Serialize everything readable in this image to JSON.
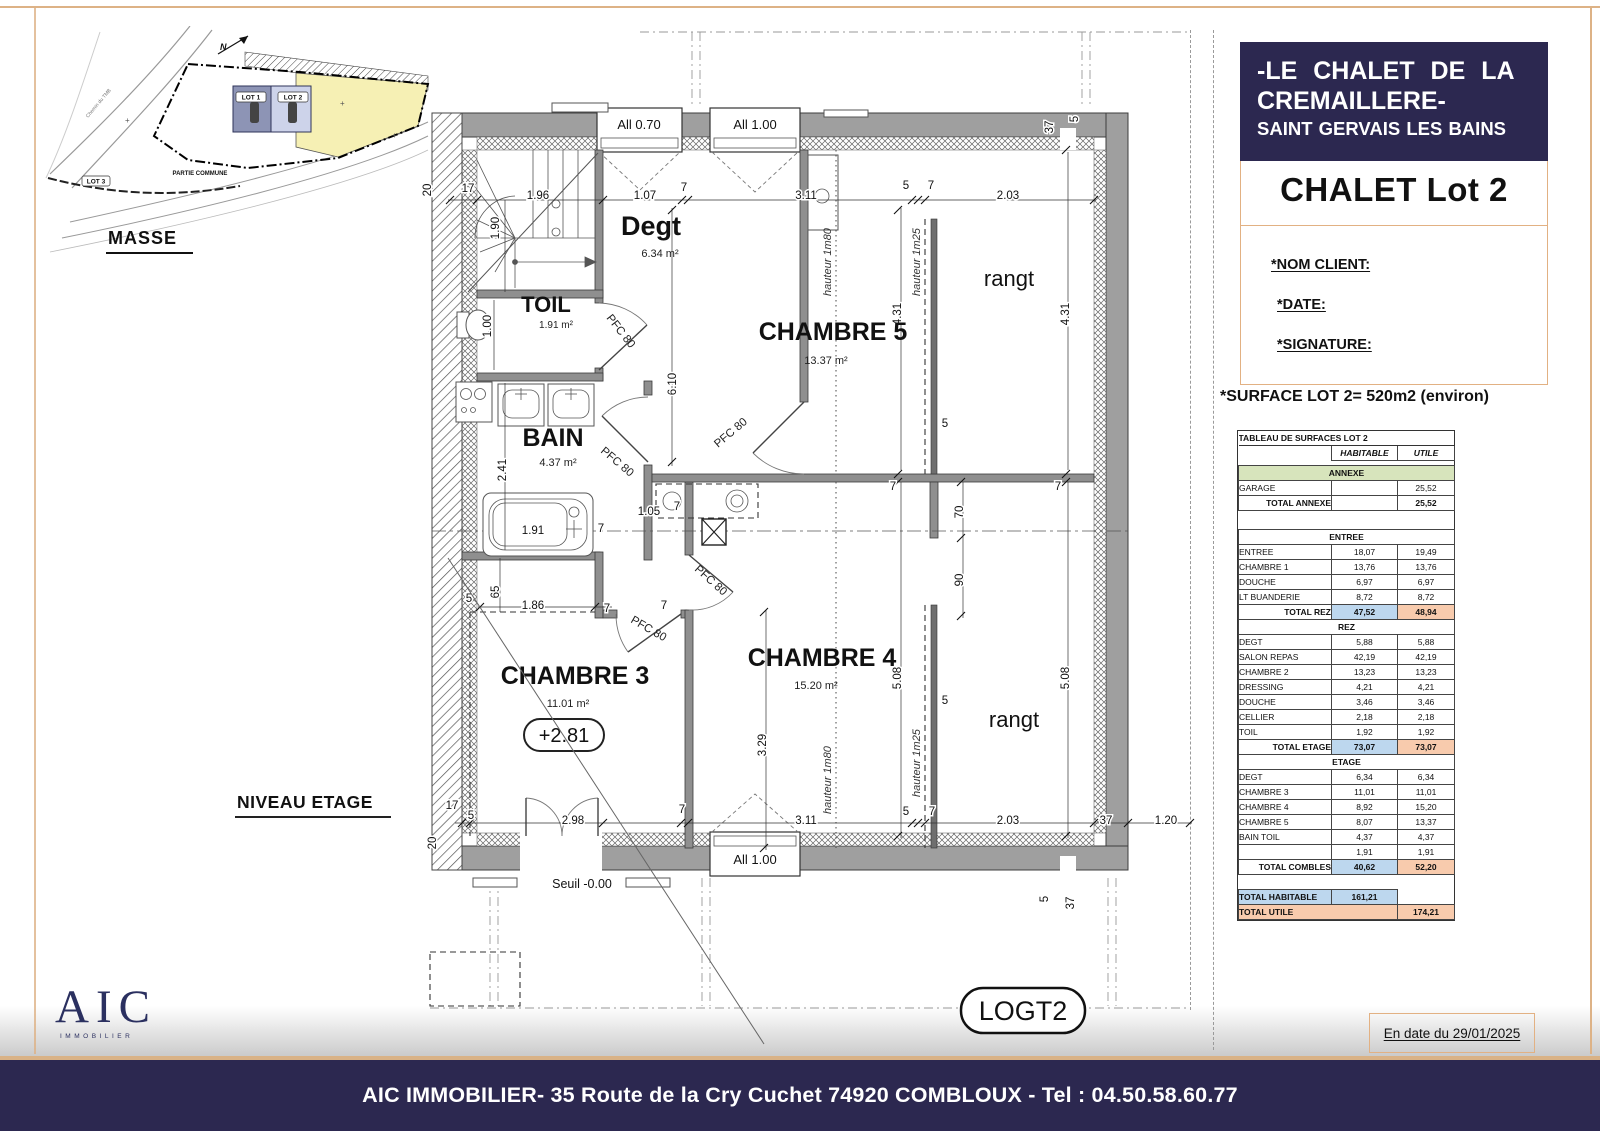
{
  "header": {
    "line1": "-LE CHALET DE LA",
    "line2": "CREMAILLERE-",
    "line3": "SAINT GERVAIS LES BAINS",
    "lot_title": "CHALET Lot 2",
    "nom_client": "*NOM CLIENT:",
    "date": "*DATE:",
    "signature": "*SIGNATURE:",
    "surface_note": "*SURFACE LOT 2= 520m2 (environ)",
    "date_box": "En date du 29/01/2025"
  },
  "logo": {
    "text": "AIC",
    "sub": "IMMOBILIER"
  },
  "footer": {
    "text": "AIC IMMOBILIER- 35 Route de la Cry Cuchet 74920 COMBLOUX - Tel : 04.50.58.60.77"
  },
  "masse": {
    "title": "MASSE",
    "lot1": "LOT 1",
    "lot2": "LOT 2",
    "lot3": "LOT 3",
    "partie_commune": "PARTIE COMMUNE",
    "road": "Chemin du TMB",
    "north": "N"
  },
  "plan": {
    "title": "NIVEAU ETAGE",
    "logt": "LOGT2",
    "north": "N",
    "seuil": "Seuil -0.00",
    "door_label": "PFC 80",
    "h180": "hauteur 1m80",
    "h125": "hauteur 1m25",
    "windows": {
      "w070": "All 0.70",
      "w100_top": "All 1.00",
      "w100_bottom": "All 1.00"
    },
    "rooms": {
      "degt": {
        "name": "Degt",
        "area": "6.34 m²"
      },
      "toil": {
        "name": "TOIL",
        "area": "1.91 m²"
      },
      "bain": {
        "name": "BAIN",
        "area": "4.37 m²"
      },
      "ch3": {
        "name": "CHAMBRE 3",
        "area": "11.01 m²",
        "level": "+2.81"
      },
      "ch4": {
        "name": "CHAMBRE 4",
        "area": "15.20 m²"
      },
      "ch5": {
        "name": "CHAMBRE 5",
        "area": "13.37 m²"
      },
      "rangt_top": "rangt",
      "rangt_bottom": "rangt"
    },
    "dims": [
      "20",
      "17",
      "1.96",
      "1.90",
      "1.07",
      "7",
      "3.11",
      "5",
      "7",
      "2.03",
      "37",
      "5",
      "1.00",
      "6.10",
      "4.31",
      "4.31",
      "2.41",
      "1.91",
      "7",
      "1.05",
      "7",
      "65",
      "5",
      "1.86",
      "7",
      "7",
      "70",
      "90",
      "5.08",
      "5.08",
      "5",
      "5",
      "3.29",
      "17",
      "20",
      "5",
      "2.98",
      "7",
      "3.11",
      "5",
      "7",
      "2.03",
      "37",
      "1.20",
      "5",
      "37",
      "7",
      "7"
    ]
  },
  "table": {
    "title": "TABLEAU DE SURFACES LOT 2",
    "col_habitable": "HABITABLE",
    "col_utile": "UTILE",
    "rows": [
      {
        "type": "colhead",
        "hab": "HABITABLE",
        "utile": "UTILE"
      },
      {
        "type": "gap",
        "h": 4
      },
      {
        "type": "section",
        "label": "ANNEXE",
        "green": true
      },
      {
        "type": "row",
        "label": "GARAGE",
        "hab": "",
        "utile": "25,52"
      },
      {
        "type": "trow",
        "label": "TOTAL ANNEXE",
        "hab": "",
        "utile": "25,52"
      },
      {
        "type": "gap",
        "h": 18
      },
      {
        "type": "section",
        "label": "ENTREE"
      },
      {
        "type": "row",
        "label": "ENTREE",
        "hab": "18,07",
        "utile": "19,49"
      },
      {
        "type": "row",
        "label": "CHAMBRE 1",
        "hab": "13,76",
        "utile": "13,76"
      },
      {
        "type": "row",
        "label": "DOUCHE",
        "hab": "6,97",
        "utile": "6,97"
      },
      {
        "type": "row",
        "label": "LT BUANDERIE",
        "hab": "8,72",
        "utile": "8,72"
      },
      {
        "type": "total",
        "label": "TOTAL REZ",
        "hab": "47,52",
        "utile": "48,94"
      },
      {
        "type": "section",
        "label": "REZ"
      },
      {
        "type": "row",
        "label": "DEGT",
        "hab": "5,88",
        "utile": "5,88"
      },
      {
        "type": "row",
        "label": "SALON REPAS",
        "hab": "42,19",
        "utile": "42,19"
      },
      {
        "type": "row",
        "label": "CHAMBRE 2",
        "hab": "13,23",
        "utile": "13,23"
      },
      {
        "type": "row",
        "label": "DRESSING",
        "hab": "4,21",
        "utile": "4,21"
      },
      {
        "type": "row",
        "label": "DOUCHE",
        "hab": "3,46",
        "utile": "3,46"
      },
      {
        "type": "row",
        "label": "CELLIER",
        "hab": "2,18",
        "utile": "2,18"
      },
      {
        "type": "row",
        "label": "TOIL",
        "hab": "1,92",
        "utile": "1,92"
      },
      {
        "type": "total",
        "label": "TOTAL ETAGE",
        "hab": "73,07",
        "utile": "73,07"
      },
      {
        "type": "section",
        "label": "ETAGE"
      },
      {
        "type": "row",
        "label": "DEGT",
        "hab": "6,34",
        "utile": "6,34"
      },
      {
        "type": "row",
        "label": "CHAMBRE 3",
        "hab": "11,01",
        "utile": "11,01"
      },
      {
        "type": "row",
        "label": "CHAMBRE 4",
        "hab": "8,92",
        "utile": "15,20"
      },
      {
        "type": "row",
        "label": "CHAMBRE 5",
        "hab": "8,07",
        "utile": "13,37"
      },
      {
        "type": "row",
        "label": "BAIN TOIL",
        "hab": "4,37",
        "utile": "4,37"
      },
      {
        "type": "row",
        "label": "",
        "hab": "1,91",
        "utile": "1,91"
      },
      {
        "type": "total",
        "label": "TOTAL COMBLES",
        "hab": "40,62",
        "utile": "52,20"
      },
      {
        "type": "gap",
        "h": 14
      },
      {
        "type": "grandhab",
        "label": "TOTAL HABITABLE",
        "hab": "161,21"
      },
      {
        "type": "grandutile",
        "label": "TOTAL UTILE",
        "utile": "174,21"
      }
    ]
  },
  "colors": {
    "navy": "#2c2850",
    "tan": "#ddb286",
    "table_green": "#d7e4bc",
    "table_blue": "#bdd7ee",
    "table_orange": "#f8cbad",
    "lot2_yellow": "#f6f0b4"
  }
}
